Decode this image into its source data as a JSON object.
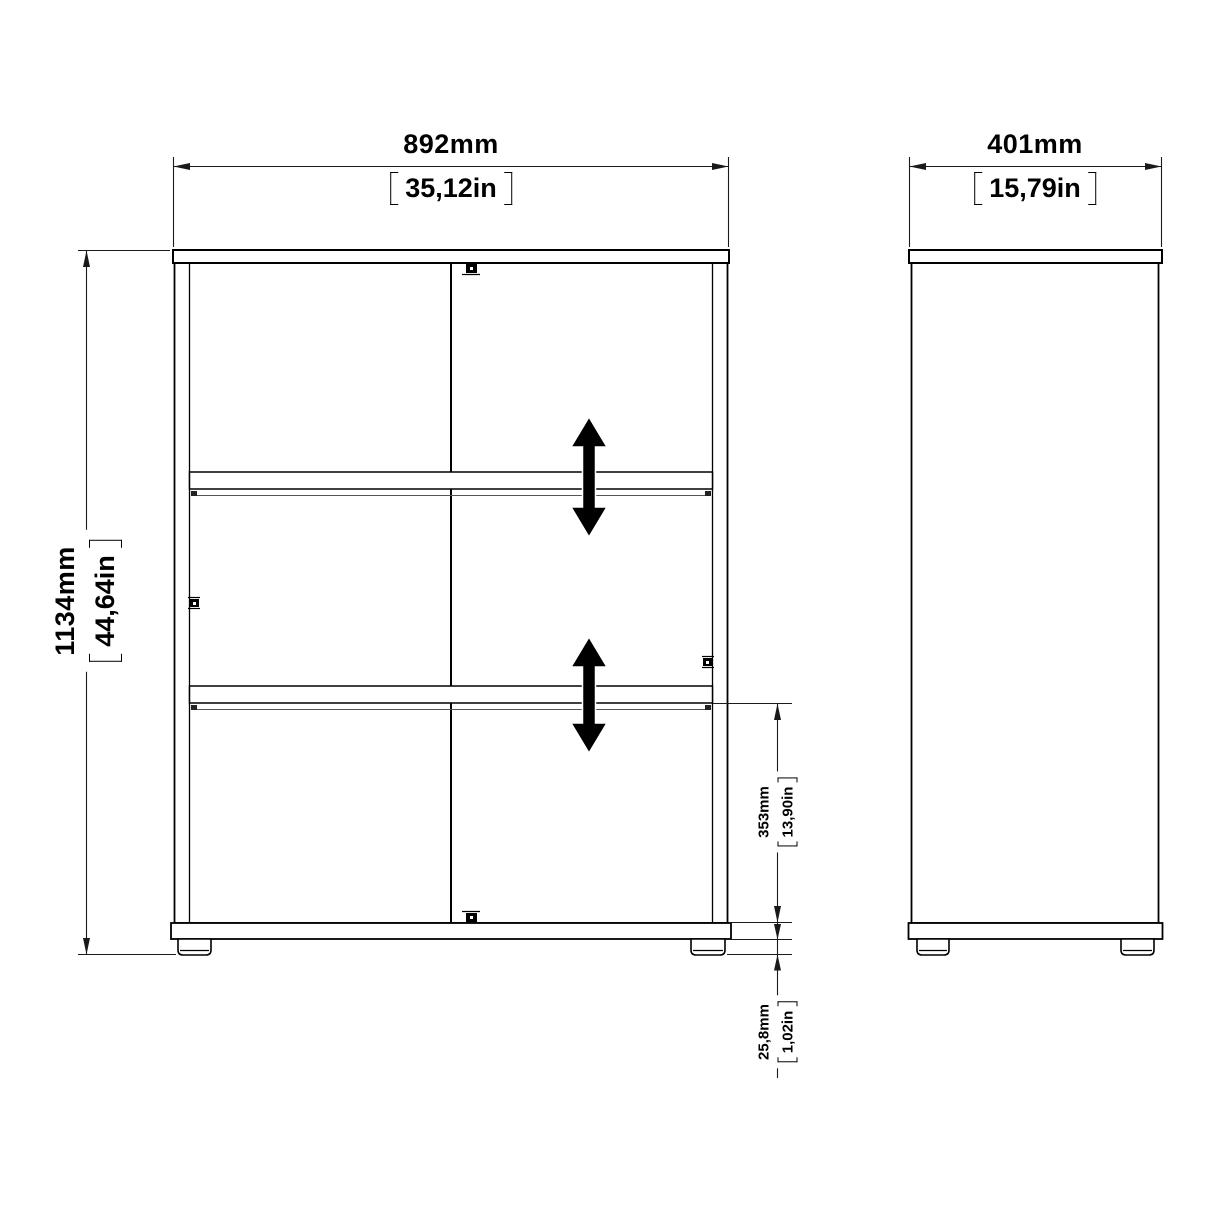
{
  "page": {
    "type": "furniture-dimension-drawing",
    "background": "#ffffff"
  },
  "views": {
    "front": {
      "name": "front view",
      "features": [
        "top panel",
        "two adjustable shelves",
        "center divider",
        "bottom panel",
        "two feet",
        "cam fasteners"
      ]
    },
    "side": {
      "name": "side view",
      "features": [
        "top panel",
        "bottom panel",
        "two feet"
      ]
    }
  },
  "dimensions": {
    "front_width": {
      "metric": "892mm",
      "imperial": "35,12in"
    },
    "front_height": {
      "metric": "1134mm",
      "imperial": "44,64in"
    },
    "side_depth": {
      "metric": "401mm",
      "imperial": "15,79in"
    },
    "lower_section_height": {
      "metric": "353mm",
      "imperial": "13,90in"
    },
    "foot_height": {
      "metric": "25,8mm",
      "imperial": "1,02in"
    }
  },
  "icons": {
    "shelf_adjust_arrow": "double-headed vertical arrow",
    "cam_fastener": "black square fitting"
  },
  "colors": {
    "object_line": "#000000",
    "dimension_line": "#1a1a1a",
    "arrow_fill": "#000000",
    "background": "#ffffff"
  }
}
